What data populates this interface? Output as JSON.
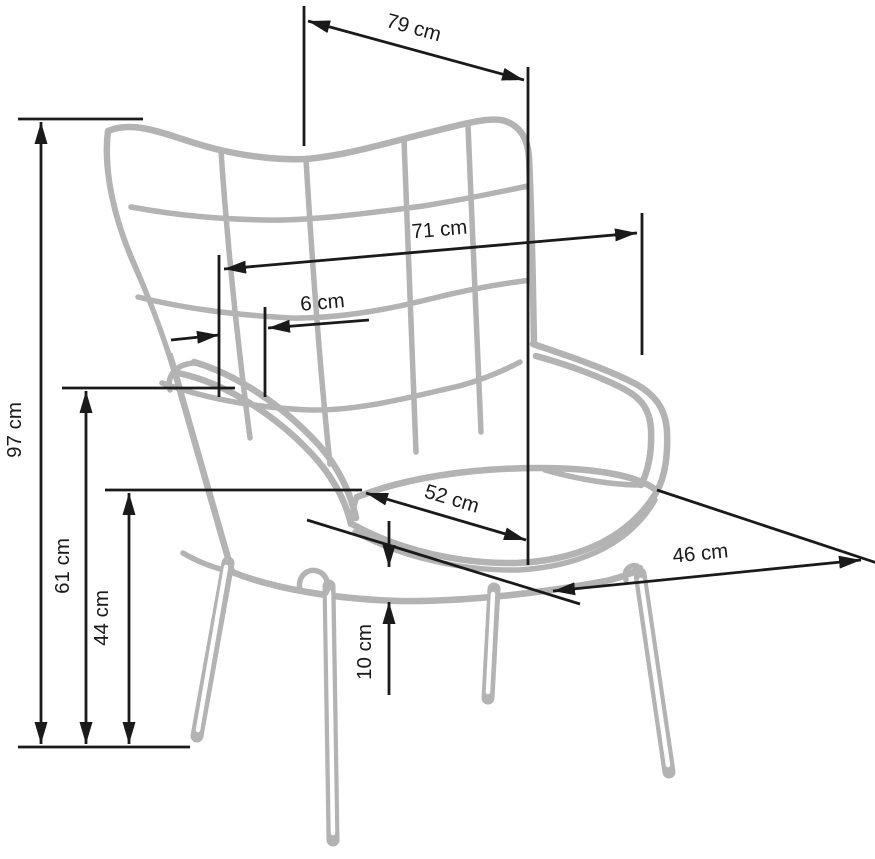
{
  "illustration": {
    "name": "wingback-armchair-line-drawing",
    "style": "gray outline sketch with tufted back, two armrests, seat cushion and four slanted legs"
  },
  "unit": "cm",
  "dimensions": {
    "depth_total": {
      "label": "79 cm",
      "value": 79,
      "orientation": "diagonal-top"
    },
    "width_back": {
      "label": "71 cm",
      "value": 71,
      "orientation": "horizontal"
    },
    "tuft_offset": {
      "label": "6 cm",
      "value": 6,
      "orientation": "horizontal"
    },
    "height_total": {
      "label": "97 cm",
      "value": 97,
      "orientation": "vertical"
    },
    "height_armrest": {
      "label": "61 cm",
      "value": 61,
      "orientation": "vertical"
    },
    "height_seat": {
      "label": "44 cm",
      "value": 44,
      "orientation": "vertical"
    },
    "cushion_thickness": {
      "label": "10 cm",
      "value": 10,
      "orientation": "vertical"
    },
    "seat_depth": {
      "label": "52 cm",
      "value": 52,
      "orientation": "diagonal-seat"
    },
    "seat_width": {
      "label": "46 cm",
      "value": 46,
      "orientation": "diagonal-front"
    }
  },
  "colors": {
    "background": "#ffffff",
    "chair_outline": "#b3b3b3",
    "dimension_lines": "#1a1a1a",
    "label_text": "#1a1a1a"
  }
}
